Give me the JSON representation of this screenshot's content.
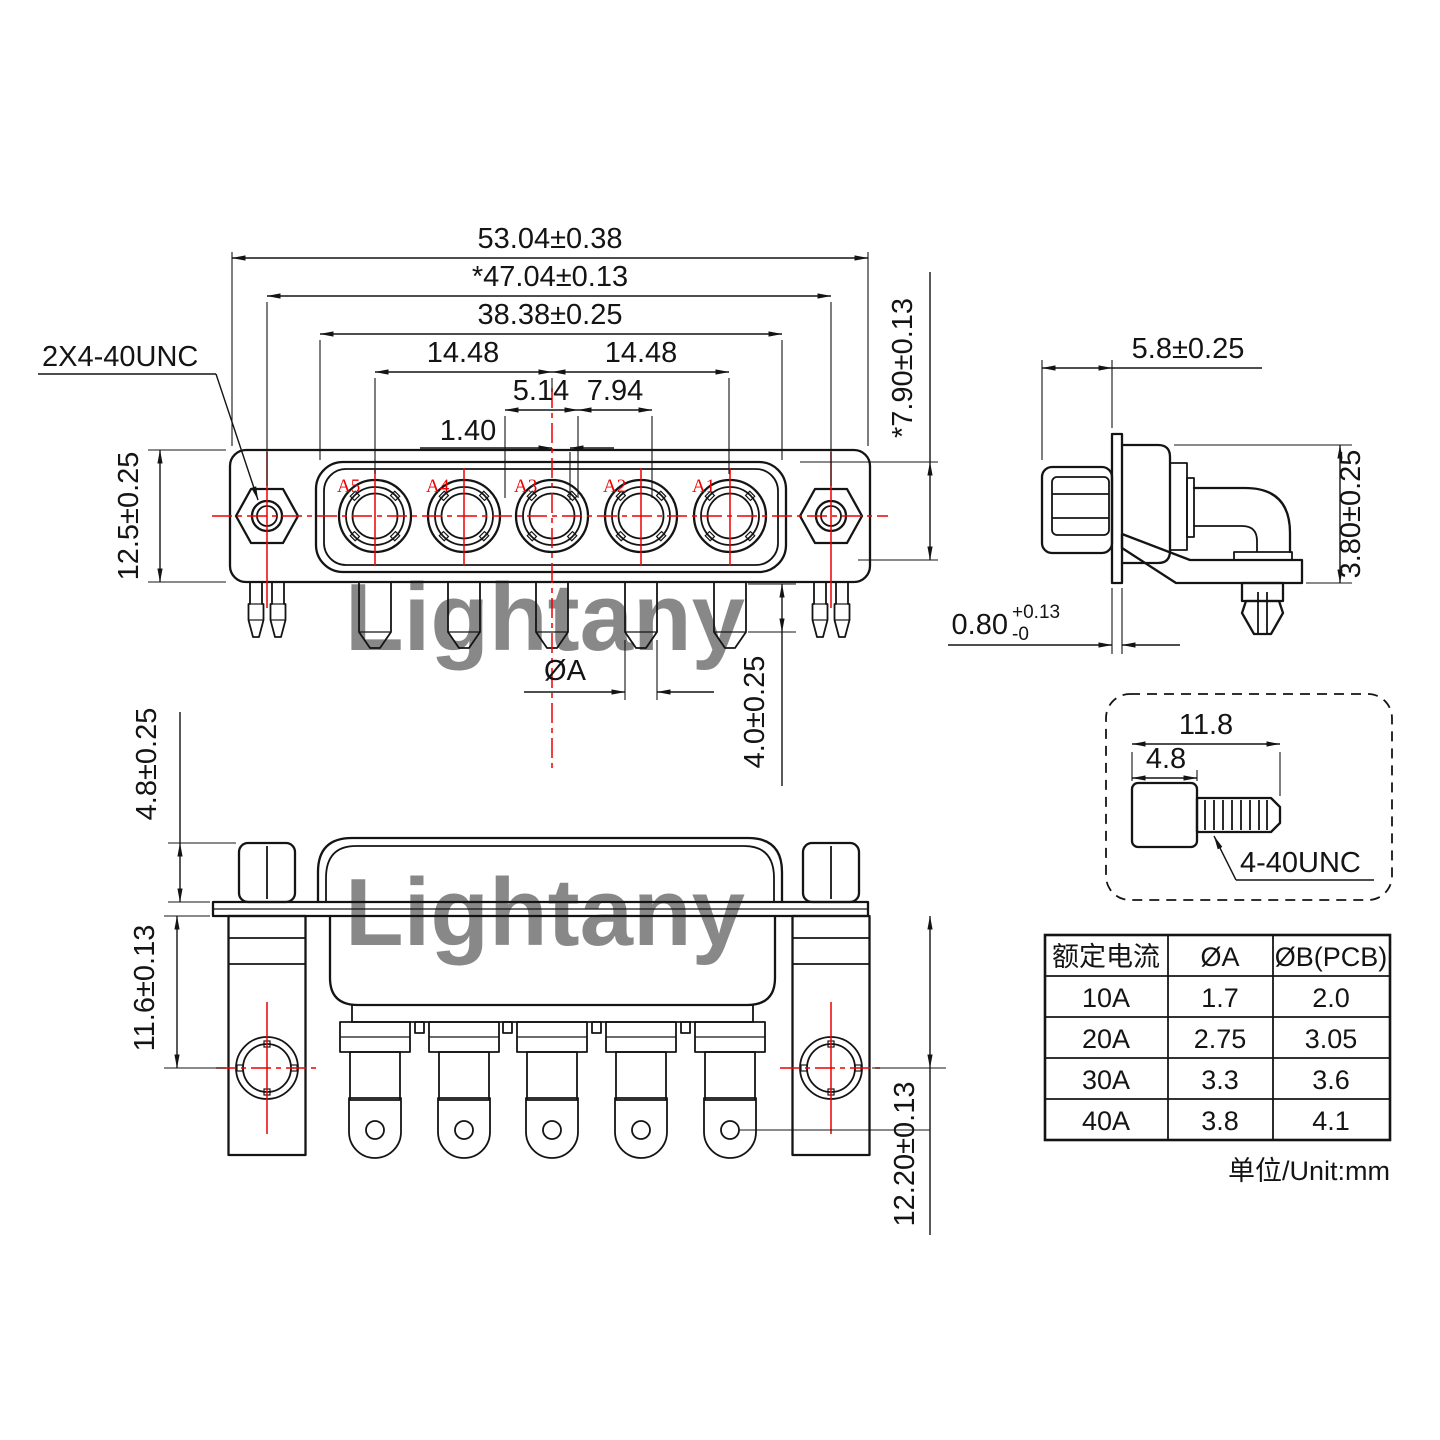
{
  "watermark": {
    "text": "Lightany",
    "color": "#f6c9c9"
  },
  "front_view": {
    "thread_label": "2X4-40UNC",
    "contacts": [
      "A5",
      "A4",
      "A3",
      "A2",
      "A1"
    ],
    "dim_overall_width": "53.04±0.38",
    "dim_mount_width": "*47.04±0.13",
    "dim_shell_width": "38.38±0.25",
    "dim_pitch_left": "14.48",
    "dim_pitch_right": "14.48",
    "dim_offset_left": "5.14",
    "dim_offset_right": "7.94",
    "dim_center_offset": "1.40",
    "dim_flange_height": "12.5±0.25",
    "dim_shell_height": "*7.90±0.13",
    "dim_pin_dia": "ØA",
    "dim_pin_length": "4.0±0.25"
  },
  "side_view": {
    "dim_front_depth": "5.8±0.25",
    "dim_bracket": "3.80±0.25",
    "dim_flange_thickness": "0.80",
    "dim_flange_tol_upper": "+0.13",
    "dim_flange_tol_lower": "-0"
  },
  "bottom_view": {
    "dim_standoff": "4.8±0.25",
    "dim_hole_offset": "11.6±0.13",
    "dim_pin_offset": "12.20±0.13"
  },
  "screw_detail": {
    "dim_total_length": "11.8",
    "dim_head_length": "4.8",
    "thread_label": "4-40UNC"
  },
  "spec_table": {
    "col_current": "额定电流",
    "col_a": "ØA",
    "col_b": "ØB(PCB)",
    "rows": [
      [
        "10A",
        "1.7",
        "2.0"
      ],
      [
        "20A",
        "2.75",
        "3.05"
      ],
      [
        "30A",
        "3.3",
        "3.6"
      ],
      [
        "40A",
        "3.8",
        "4.1"
      ]
    ],
    "unit_note": "单位/Unit:mm"
  }
}
